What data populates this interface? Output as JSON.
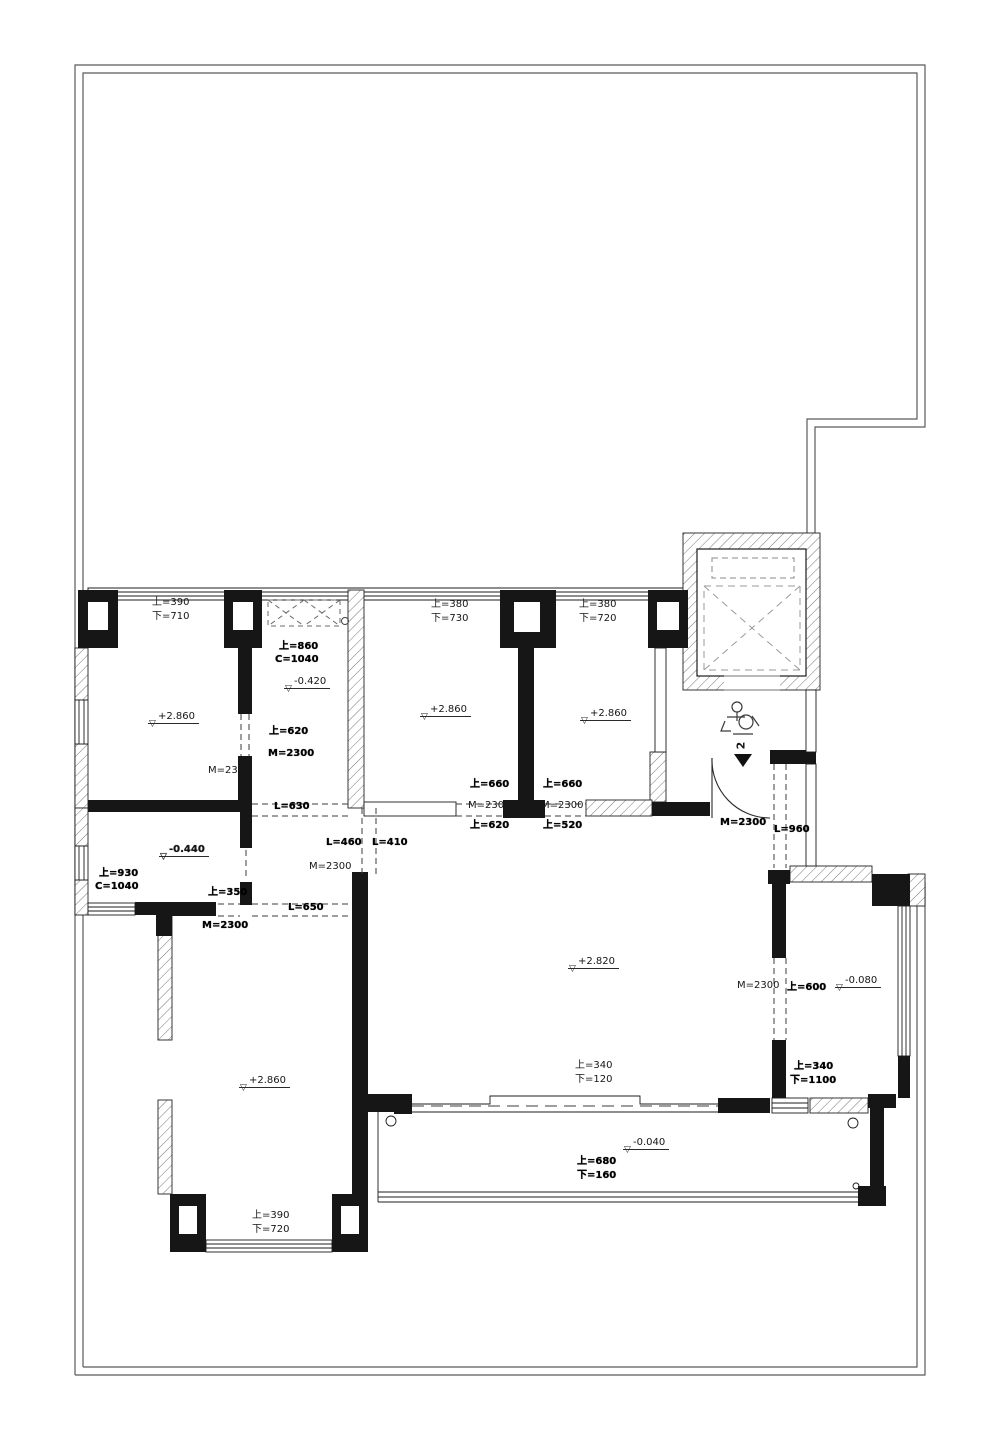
{
  "plan": {
    "type": "architectural-floor-plan",
    "colors": {
      "line": "#1c1c1c",
      "boundary": "#5a5a5a",
      "hatch": "#777777",
      "background": "#ffffff"
    },
    "section_mark": {
      "number": "2"
    },
    "labels": [
      {
        "text": "上=390",
        "x": 152,
        "y": 597,
        "style": "n"
      },
      {
        "text": "下=710",
        "x": 152,
        "y": 611,
        "style": "n"
      },
      {
        "text": "上=380",
        "x": 431,
        "y": 599,
        "style": "n"
      },
      {
        "text": "下=730",
        "x": 431,
        "y": 613,
        "style": "n"
      },
      {
        "text": "上=380",
        "x": 579,
        "y": 599,
        "style": "n"
      },
      {
        "text": "下=720",
        "x": 579,
        "y": 613,
        "style": "n"
      },
      {
        "text": "上=860",
        "x": 279,
        "y": 641,
        "style": "b"
      },
      {
        "text": "C=1040",
        "x": 275,
        "y": 654,
        "style": "b"
      },
      {
        "text": "-0.420",
        "x": 284,
        "y": 677,
        "style": "e"
      },
      {
        "text": "+2.860",
        "x": 148,
        "y": 712,
        "style": "e"
      },
      {
        "text": "+2.860",
        "x": 420,
        "y": 705,
        "style": "e"
      },
      {
        "text": "+2.860",
        "x": 580,
        "y": 709,
        "style": "e"
      },
      {
        "text": "上=620",
        "x": 269,
        "y": 726,
        "style": "b"
      },
      {
        "text": "M=2300",
        "x": 268,
        "y": 748,
        "style": "b"
      },
      {
        "text": "M=2300",
        "x": 208,
        "y": 765,
        "style": "n"
      },
      {
        "text": "L=630",
        "x": 274,
        "y": 801,
        "style": "b"
      },
      {
        "text": "上=660",
        "x": 470,
        "y": 779,
        "style": "b"
      },
      {
        "text": "M=2300",
        "x": 468,
        "y": 800,
        "style": "n"
      },
      {
        "text": "上=620",
        "x": 470,
        "y": 820,
        "style": "b"
      },
      {
        "text": "上=660",
        "x": 543,
        "y": 779,
        "style": "b"
      },
      {
        "text": "M=2300",
        "x": 541,
        "y": 800,
        "style": "n"
      },
      {
        "text": "上=520",
        "x": 543,
        "y": 820,
        "style": "b"
      },
      {
        "text": "L=460",
        "x": 326,
        "y": 837,
        "style": "b"
      },
      {
        "text": "L=410",
        "x": 372,
        "y": 837,
        "style": "b"
      },
      {
        "text": "M=2300",
        "x": 309,
        "y": 861,
        "style": "n"
      },
      {
        "text": "-0.440",
        "x": 159,
        "y": 845,
        "style": "eb"
      },
      {
        "text": "上=930",
        "x": 99,
        "y": 868,
        "style": "b"
      },
      {
        "text": "C=1040",
        "x": 95,
        "y": 881,
        "style": "b"
      },
      {
        "text": "上=350",
        "x": 208,
        "y": 887,
        "style": "b"
      },
      {
        "text": "L=650",
        "x": 288,
        "y": 902,
        "style": "b"
      },
      {
        "text": "M=2300",
        "x": 202,
        "y": 920,
        "style": "b"
      },
      {
        "text": "M=2300",
        "x": 720,
        "y": 817,
        "style": "b"
      },
      {
        "text": "L=960",
        "x": 774,
        "y": 824,
        "style": "b"
      },
      {
        "text": "+2.820",
        "x": 568,
        "y": 957,
        "style": "e"
      },
      {
        "text": "M=2300",
        "x": 737,
        "y": 980,
        "style": "n"
      },
      {
        "text": "上=600",
        "x": 787,
        "y": 982,
        "style": "b"
      },
      {
        "text": "-0.080",
        "x": 835,
        "y": 976,
        "style": "e"
      },
      {
        "text": "上=340",
        "x": 575,
        "y": 1060,
        "style": "n"
      },
      {
        "text": "下=120",
        "x": 575,
        "y": 1074,
        "style": "n"
      },
      {
        "text": "上=340",
        "x": 794,
        "y": 1061,
        "style": "b"
      },
      {
        "text": "下=1100",
        "x": 790,
        "y": 1075,
        "style": "b"
      },
      {
        "text": "-0.040",
        "x": 623,
        "y": 1138,
        "style": "e"
      },
      {
        "text": "上=680",
        "x": 577,
        "y": 1156,
        "style": "b"
      },
      {
        "text": "下=160",
        "x": 577,
        "y": 1170,
        "style": "b"
      },
      {
        "text": "+2.860",
        "x": 239,
        "y": 1076,
        "style": "e"
      },
      {
        "text": "上=390",
        "x": 252,
        "y": 1210,
        "style": "n"
      },
      {
        "text": "下=720",
        "x": 252,
        "y": 1224,
        "style": "n"
      },
      {
        "text": "2",
        "x": 737,
        "y": 740,
        "style": "m"
      }
    ]
  }
}
